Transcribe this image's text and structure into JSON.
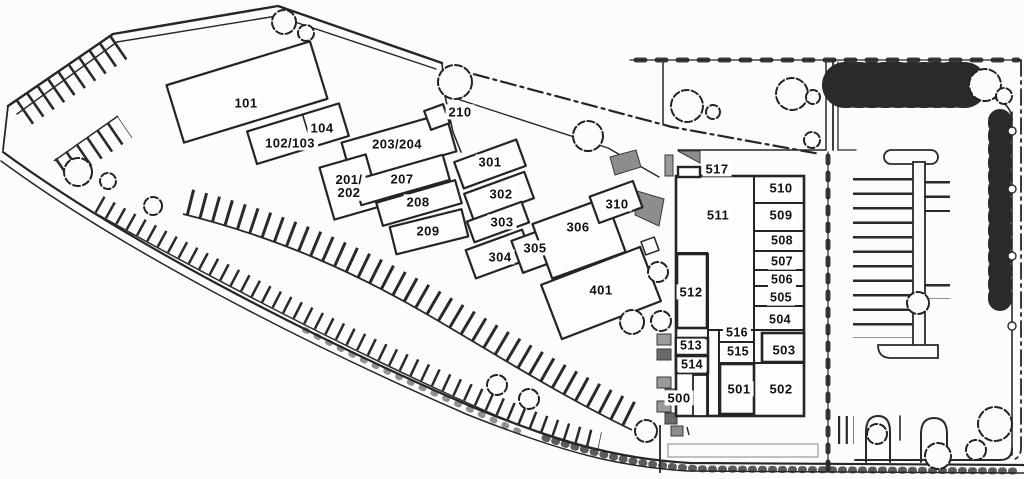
{
  "colors": {
    "ink": "#262626",
    "paper": "#fcfcfa",
    "building_fill": "#fdfdfc",
    "shade": "#8d8d8d",
    "shade_dark": "#6a6a6a",
    "label_bg": "#ffffff",
    "label_text": "#111111"
  },
  "labels": {
    "l101": "101",
    "l102_103": "102/103",
    "l104": "104",
    "l201_202": "201/\n202",
    "l203_204": "203/204",
    "l207": "207",
    "l208": "208",
    "l209": "209",
    "l210": "210",
    "l301": "301",
    "l302": "302",
    "l303": "303",
    "l304": "304",
    "l305": "305",
    "l306": "306",
    "l310": "310",
    "l401": "401",
    "l500": "500",
    "l501": "501",
    "l502": "502",
    "l503": "503",
    "l504": "504",
    "l505": "505",
    "l506": "506",
    "l507": "507",
    "l508": "508",
    "l509": "509",
    "l510": "510",
    "l511": "511",
    "l512": "512",
    "l513": "513",
    "l514": "514",
    "l515": "515",
    "l516": "516",
    "l517": "517"
  }
}
